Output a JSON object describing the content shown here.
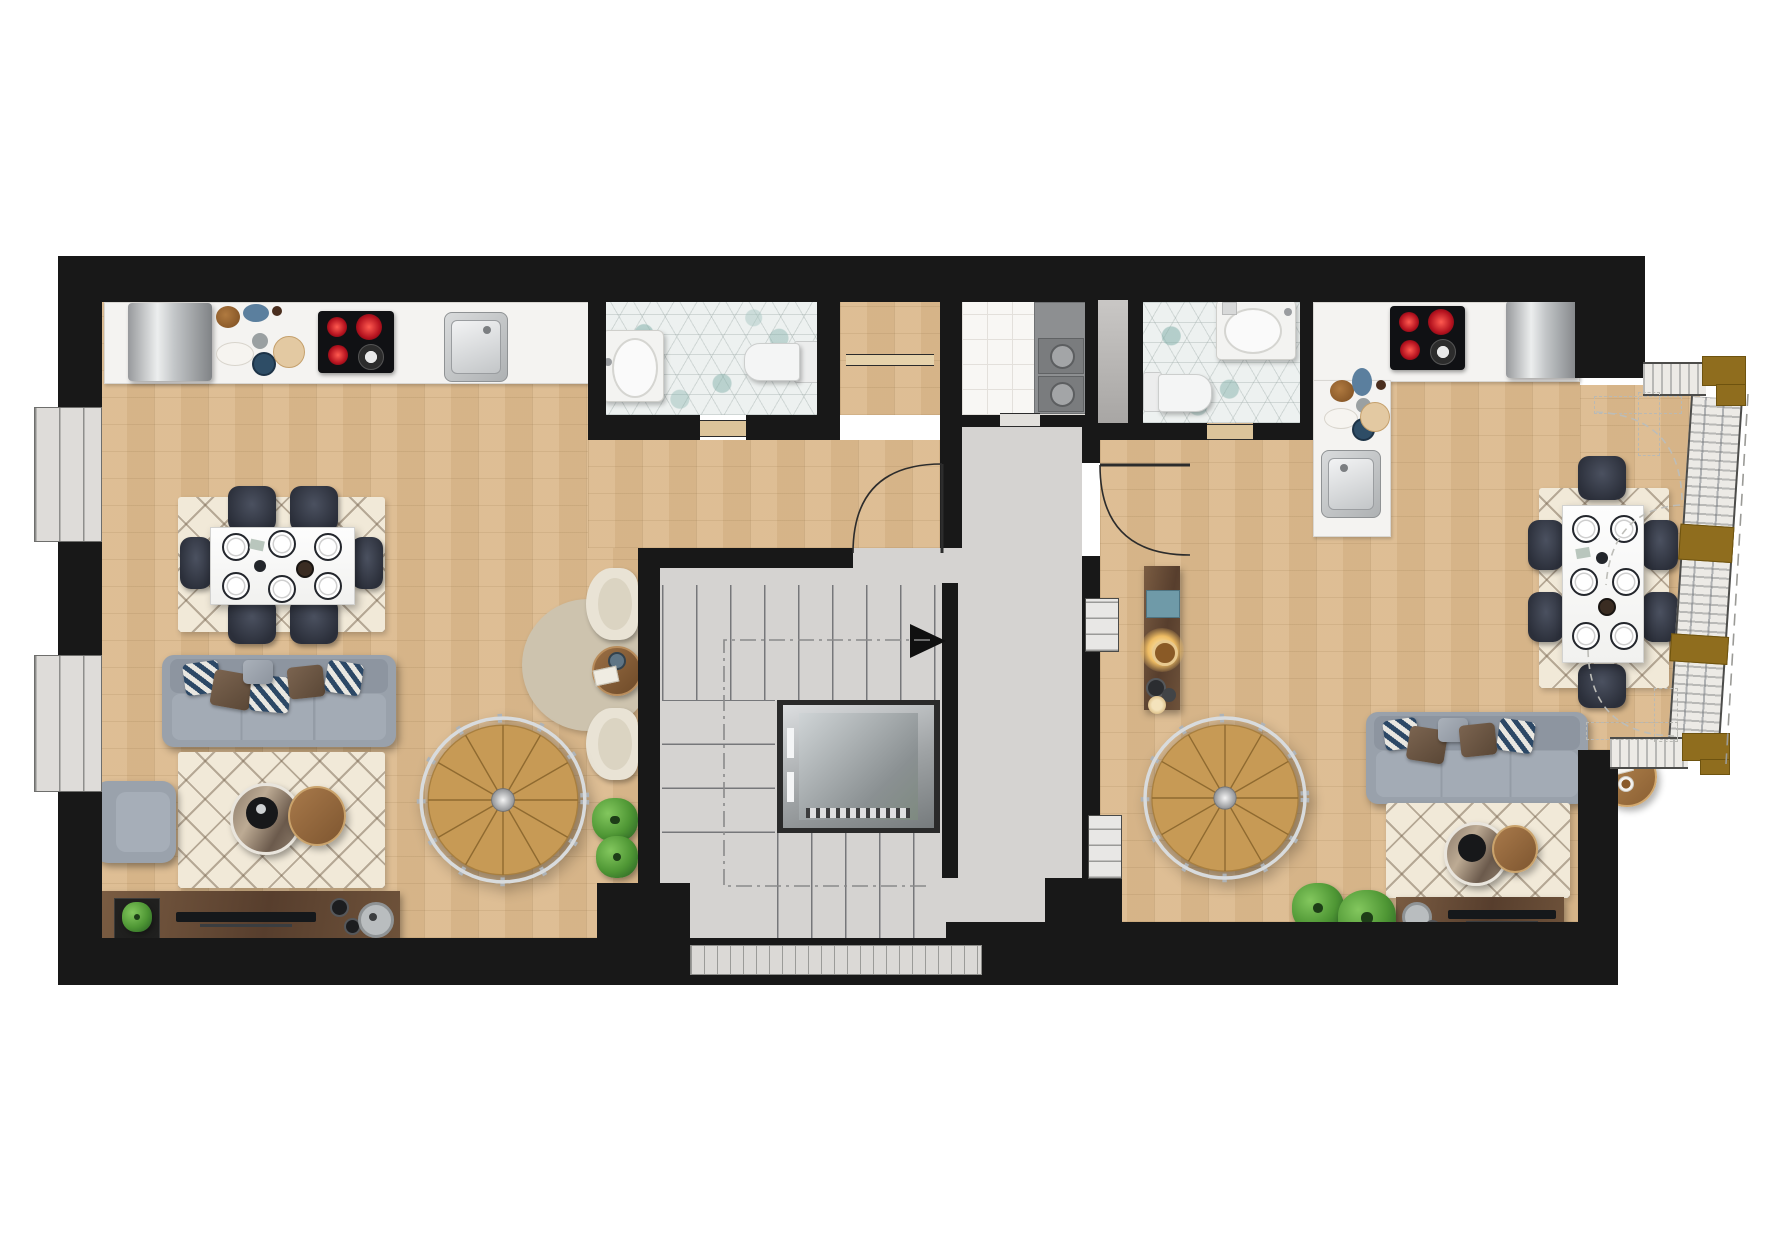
{
  "document": {
    "type": "architectural floor plan",
    "view": "top-down rendered color plan",
    "visible_text": [],
    "storey": "two apartments around a central stair and lift core"
  },
  "palette": {
    "wall": "#181818",
    "wood_floor": "#dcba8e",
    "core_floor": "#d5d3d1",
    "bath_tile": "#edf1f0",
    "bath_tile_accent": "#9dc2bc",
    "laundry_tile": "#f8f7f4",
    "counter": "#f4f3f1",
    "rug_cream": "#f1e9d8",
    "sofa_gray": "#99a1ab",
    "chair_dark": "#343a46",
    "walnut": "#6d5443",
    "spiral_wood": "#c79a55",
    "railing": "#c9cdd0",
    "pillow_navy": "#2c4866",
    "pillow_brown": "#6f5a47",
    "plant_green": "#55a03e",
    "facade_post_brown": "#8f6d1e",
    "hob_red": "#c81f2d",
    "lamp_glow": "#f2c177"
  },
  "core": {
    "stairwell": {
      "upper_flight_treads": 8,
      "lower_flight_treads": 5,
      "landing_steps": 2,
      "direction_arrow": "points right",
      "walk_line_style": "dash-dot loop"
    },
    "elevator": {
      "location": "center of stairwell",
      "rendered": "3D shaft view with door slits and threshold"
    },
    "hallway": {
      "shape": "L-shaped landing serving both apartment entry doors",
      "niches": 2
    },
    "laundry_room": {
      "floor": "white square tile",
      "stacked_machines": 2
    },
    "utility_shaft_door": 1,
    "entrance_paving": "tick-marked strip at bottom of core"
  },
  "apartments": {
    "left": {
      "kitchen": {
        "layout": "straight run on top wall",
        "items": [
          "fridge",
          "prep dishes",
          "induction hob with 3 red and 1 gray burners",
          "steel sink"
        ]
      },
      "dining": {
        "table": "white rectangular set for six",
        "chairs": 6,
        "rug": "cream berber diamond"
      },
      "living": {
        "sofa": "gray 3-seat with navy chevron and brown pillows",
        "armchair": "gray",
        "coffee_tables": [
          "round marble nesting table",
          "round wood nesting table"
        ],
        "rug": "cream berber diamond",
        "tv_console": "walnut with plant, TV bar, records and speaker",
        "reading_nook": {
          "round_rug": "beige",
          "cream_chairs": 2,
          "side_table": "walnut round"
        },
        "spiral_staircase": "wood treads with light railing",
        "plants": 2
      },
      "bathroom": {
        "floor": "teal hex mosaic",
        "fixtures": [
          "vanity sink",
          "toilet"
        ]
      },
      "closet": {
        "door": "double-line front"
      },
      "windows_on_left_wall": 2,
      "entry_door": "swings from core landing"
    },
    "right": {
      "kitchen": {
        "layout": "L-shaped",
        "items": [
          "induction hob with 3 red and 1 gray burners",
          "fridge",
          "prep dishes",
          "steel sink"
        ]
      },
      "dining": {
        "table": "white rectangular set for six",
        "chairs": 6,
        "rug": "cream berber diamond"
      },
      "living": {
        "sofa": "gray 3-seat with navy chevron and brown pillows",
        "coffee_tables": [
          "round marble nesting table",
          "round wood nesting table"
        ],
        "side_table": "round wood with papers and coffee cup",
        "rug": "cream berber diamond",
        "tv_console": "walnut with TV bar and speaker",
        "entry_console": "walnut with glowing lamp and teal tray",
        "spiral_staircase": "wood treads with light railing",
        "plants": 2
      },
      "bathroom": {
        "floor": "teal hex mosaic",
        "fixtures": [
          "sink",
          "toilet"
        ]
      },
      "glazed_bay": {
        "side": "east",
        "folding_door_swings": "dashed arcs",
        "brown_posts": 4,
        "outer_dashed_line": true
      },
      "entry_door": "swings from core landing"
    }
  }
}
